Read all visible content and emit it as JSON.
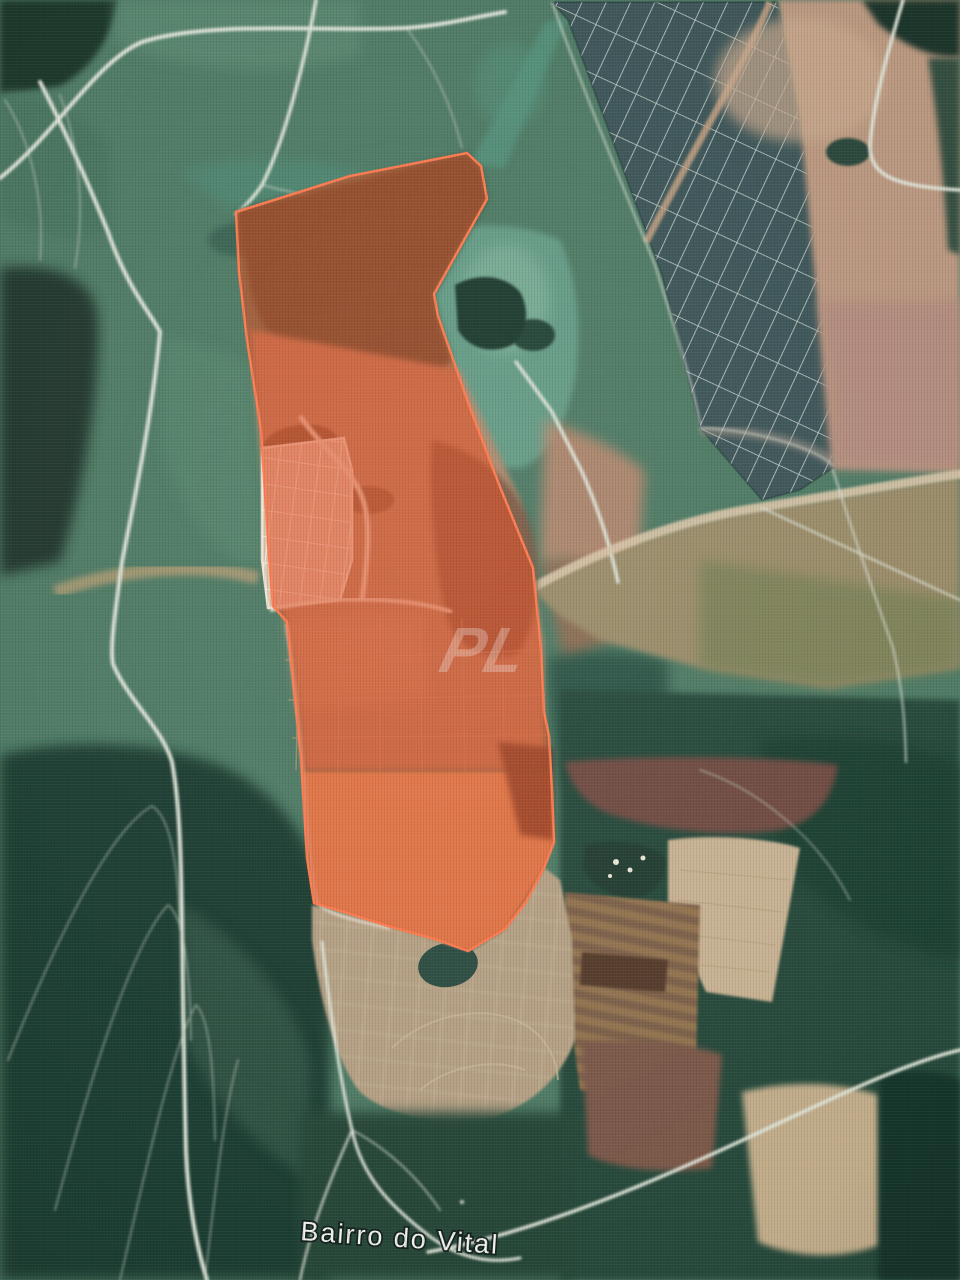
{
  "map": {
    "view_type": "satellite-imagery",
    "place_label": "Bairro do Vital",
    "watermark_text": "PL",
    "overlay_polygon": {
      "name": "highlighted-land-parcel",
      "fill": "#e8481c",
      "fill_opacity": "0.55",
      "stroke": "#ff7a4e"
    },
    "palette": {
      "field_green": "#4f7b65",
      "forest_dark": "#1f3d31",
      "teal_vegetation": "#5e9a86",
      "bare_soil_tan": "#bb9880",
      "pink_soil": "#b28b7e",
      "khaki_field": "#9b8d6b",
      "olive_field": "#7c8259",
      "plantation_grid_dark": "#3b5356",
      "road_white": "#dfe4d8",
      "plowed_bright": "#d9a878",
      "maroon_field": "#6f4c43",
      "label_color": "#eef1ee"
    }
  }
}
